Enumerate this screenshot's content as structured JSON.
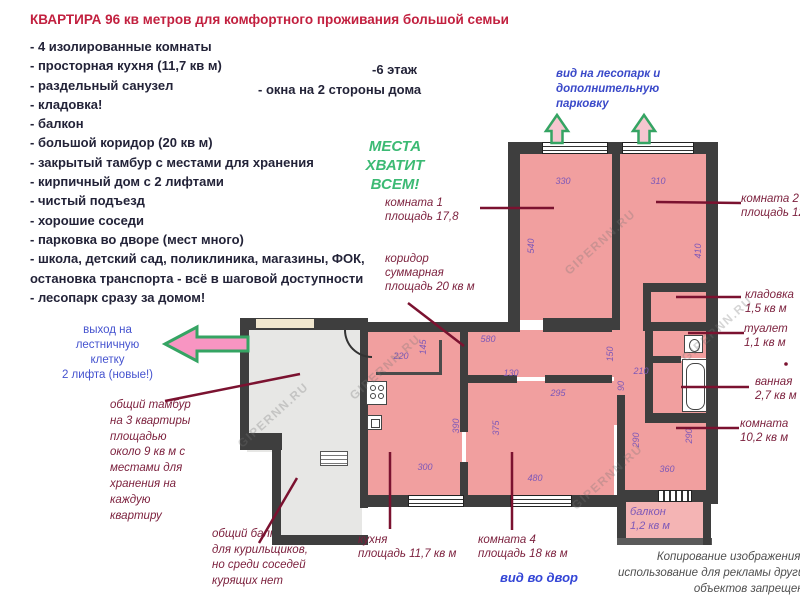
{
  "title": "КВАРТИРА 96 кв метров  для комфортного проживания большой семьи",
  "features": [
    "- 4 изолированные комнаты",
    "- просторная кухня (11,7 кв м)",
    "- раздельный санузел",
    "- кладовка!",
    "- балкон",
    "- большой коридор (20 кв м)",
    "- закрытый тамбур с местами для хранения",
    "- кирпичный дом с 2 лифтами",
    "- чистый подъезд",
    "- хорошие соседи",
    "- парковка во дворе (мест много)",
    "- школа, детский сад, поликлиника, магазины, ФОК, остановка транспорта - всё в шаговой доступности",
    "- лесопарк сразу за домом!"
  ],
  "floor_note": "-6 этаж",
  "windows_note": "- окна на 2 стороны дома",
  "slogan": {
    "line1": "МЕСТА ХВАТИТ",
    "line2": "ВСЕМ!"
  },
  "park_view_note": {
    "line1": "вид на лесопарк и",
    "line2": "дополнительную",
    "line3": "парковку"
  },
  "exit_note": {
    "line1": "выход на",
    "line2": "лестничную",
    "line3": "клетку",
    "line4": "2 лифта (новые!)"
  },
  "tambour_note": {
    "line1": "общий тамбур",
    "line2": "на 3 квартиры",
    "line3": "площадью",
    "line4": "около 9 кв м с",
    "line5": "местами для",
    "line6": "хранения на",
    "line7": "каждую",
    "line8": "квартиру"
  },
  "smoker_balcony_note": {
    "line1": "общий балкон",
    "line2": "для курильщиков,",
    "line3": "но среди соседей",
    "line4": "курящих нет"
  },
  "labels": {
    "room1": {
      "line1": "комната 1",
      "line2": "площадь 17,8"
    },
    "corridor": {
      "line1": "коридор",
      "line2": "суммарная",
      "line3": "площадь 20 кв м"
    },
    "room2": {
      "line1": "комната 2",
      "line2": "площадь 12"
    },
    "storage": {
      "line1": "кладовка",
      "line2": "1,5 кв м"
    },
    "toilet": {
      "line1": "туалет",
      "line2": "1,1 кв м"
    },
    "bathroom": {
      "line1": "ванная",
      "line2": "2,7 кв м"
    },
    "room3": {
      "line1": "комната",
      "line2": "10,2 кв м"
    },
    "kitchen": {
      "line1": "кухня",
      "line2": "площадь 11,7 кв м"
    },
    "room4": {
      "line1": "комната 4",
      "line2": "площадь 18 кв м"
    },
    "yard_view": "вид во двор",
    "balcony": {
      "line1": "балкон",
      "line2": "1,2 кв м"
    }
  },
  "plan_dims": {
    "room1_width": "330",
    "room2_width": "310",
    "room1_height": "540",
    "room2_height": "410",
    "nook_width": "220",
    "nook_height": "145",
    "corridor_width": "580",
    "corridor_right_height": "150",
    "door_width": "130",
    "corridor_segment": "295",
    "bath_width": "210",
    "bath_step": "90",
    "kitchen_height": "390",
    "room4_height": "375",
    "kitchen_width": "300",
    "room4_width": "480",
    "room3_left_height": "290",
    "room3_right_height": "290",
    "room3_width": "360"
  },
  "watermark": "GIPERNN.RU",
  "copyright": {
    "line1": "Копирование изображения и",
    "line2": "использование для рекламы других",
    "line3": "объектов запрещено"
  },
  "colors": {
    "title": "#c2203f",
    "accent_green": "#3cba74",
    "accent_blue": "#3a49c9",
    "label_red": "#7b1f3c",
    "dim_purple": "#7d58b8",
    "wall": "#3e3e3e",
    "room_fill": "#f19f9f"
  }
}
